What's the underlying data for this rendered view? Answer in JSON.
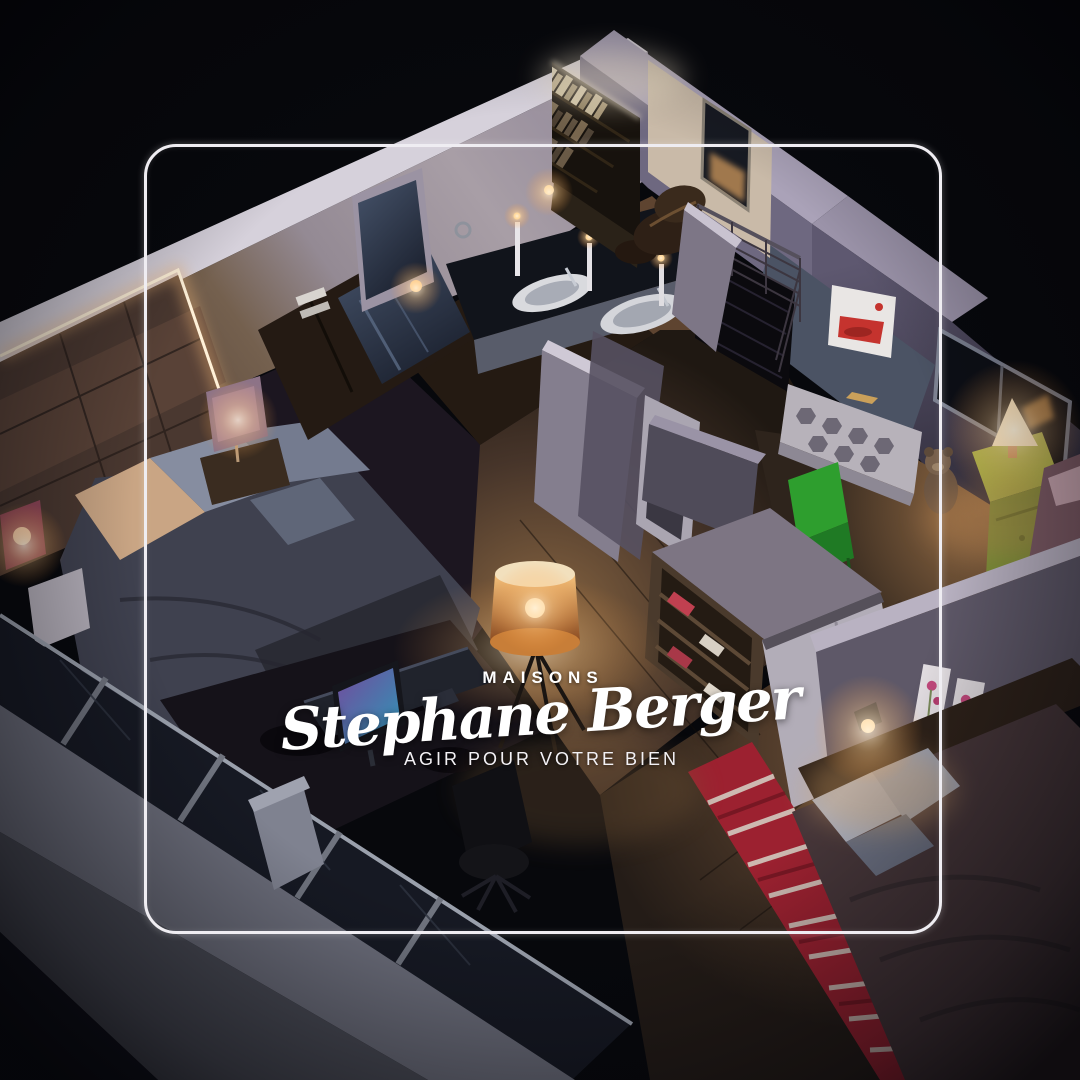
{
  "brand": {
    "eyebrow": "MAISONS",
    "name": "Stephane Berger",
    "tagline": "AGIR POUR VOTRE BIEN"
  },
  "colors": {
    "background": "#07080c",
    "frame": "#efedf2",
    "text": "#ffffff",
    "warm_light": "#ffc985",
    "led": "#fff1d8",
    "rug_red": "#9c2130",
    "kids_green": "#2e9e2e",
    "poster_red": "#c5332e"
  },
  "scene": {
    "type": "night 3D cutaway floor-plan render",
    "rooms": [
      "master-bedroom",
      "bathroom",
      "office-mezzanine",
      "kids-room",
      "bedroom-2",
      "hallway",
      "desk-area",
      "balcony"
    ]
  }
}
